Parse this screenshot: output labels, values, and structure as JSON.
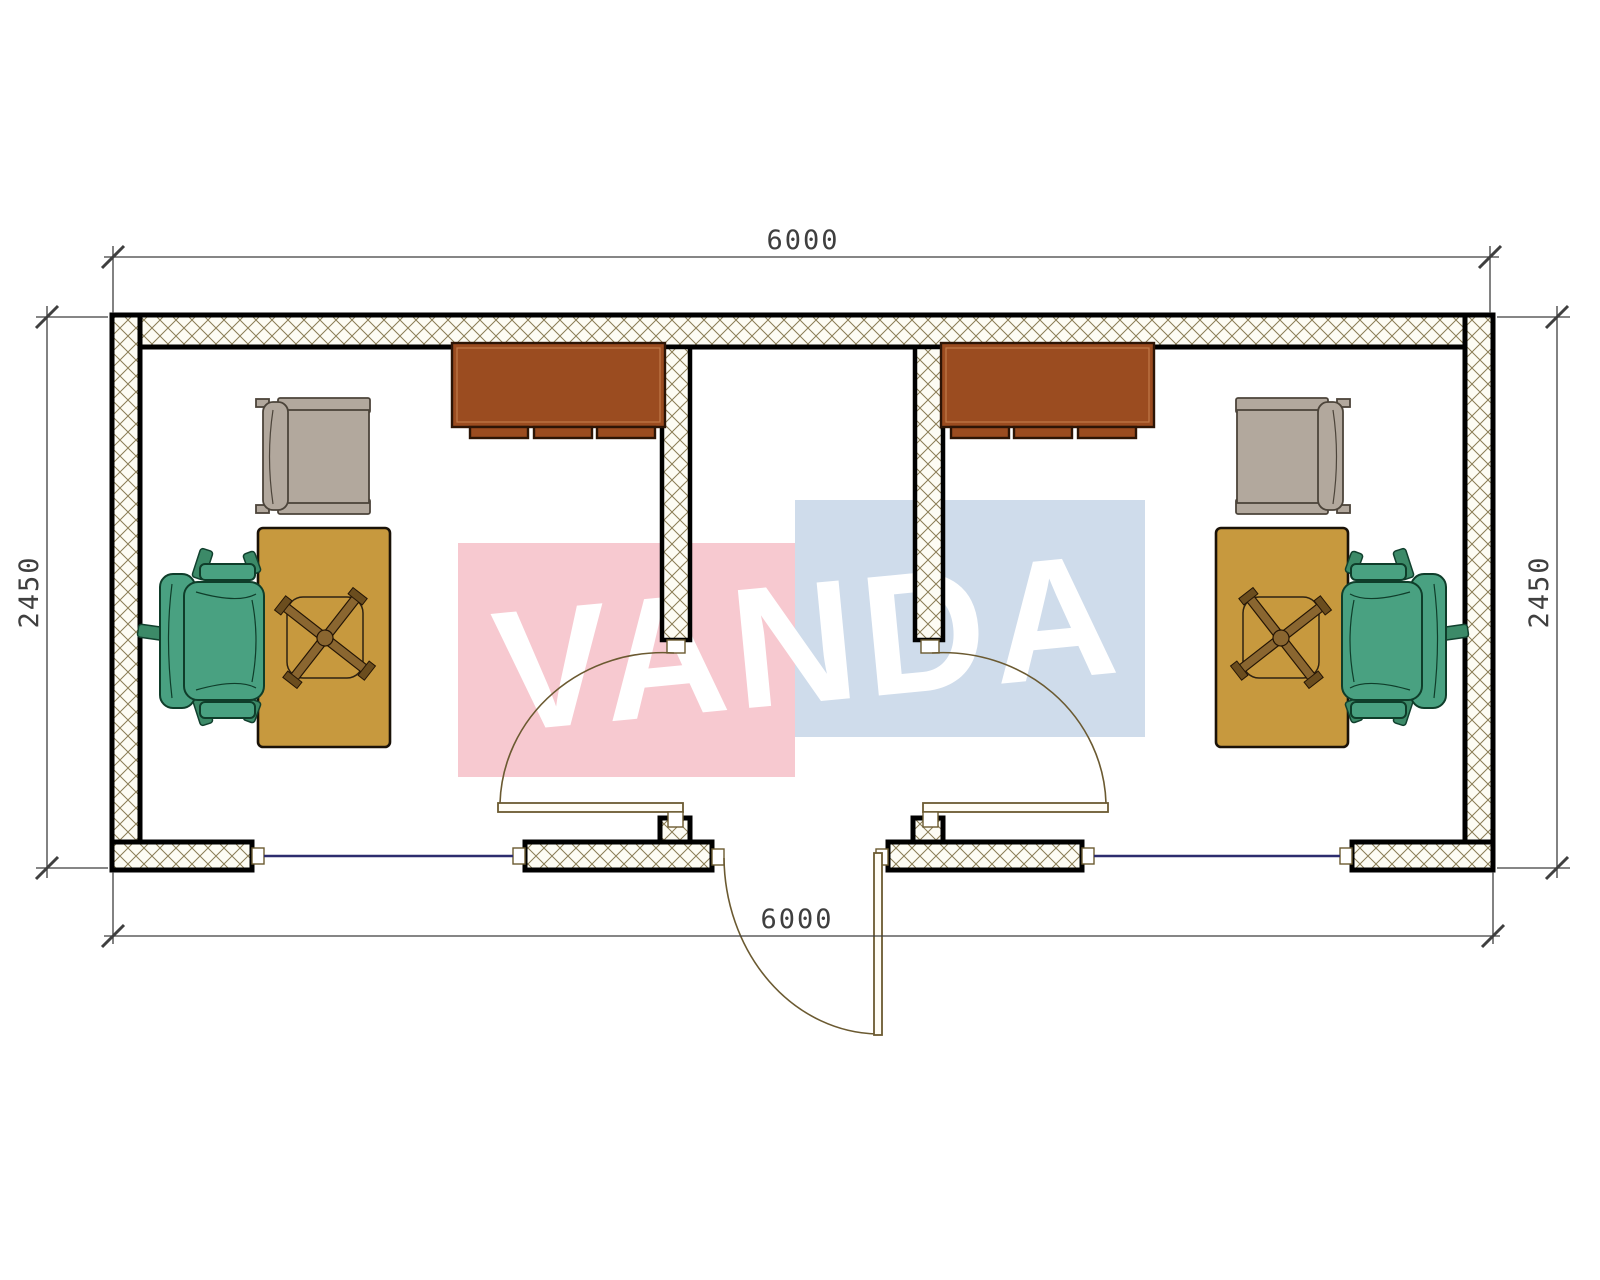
{
  "watermark": {
    "text": "VANDA"
  },
  "dimensions": {
    "top": "6000",
    "bottom": "6000",
    "left": "2450",
    "right": "2450"
  },
  "plan": {
    "type": "floor-plan",
    "rooms": [
      "office-left",
      "entrance-hall",
      "office-right"
    ],
    "furniture_icons": [
      "cabinet-icon",
      "visitor-chair-icon",
      "desk-icon",
      "task-chair-base-icon",
      "office-chair-icon"
    ],
    "openings": [
      "window-left",
      "entrance-door",
      "window-right",
      "room-door-left",
      "room-door-right"
    ]
  },
  "colors": {
    "wall-line": "#000000",
    "hatch-line": "#8a7c55",
    "hatch-bg": "#fdfcf4",
    "annotation": "#3f3f3f",
    "door-line": "#6b5a31",
    "window-line": "#2c2c6e",
    "cabinet": "#9b4c20",
    "desk": "#c7993e",
    "office-chair": "#49a181",
    "visitor-chair": "#b2a89d",
    "wm-pink": "#f7c9d0",
    "wm-blue": "#cfdceb"
  }
}
